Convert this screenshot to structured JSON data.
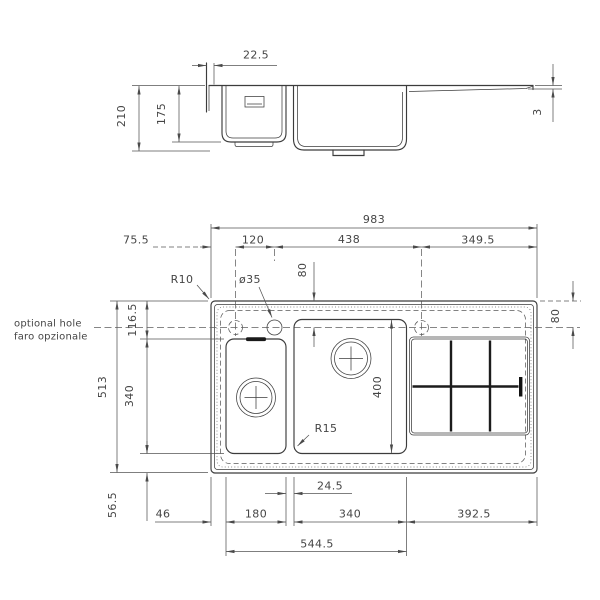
{
  "side_view": {
    "rim_offset": "22.5",
    "total_depth": "210",
    "bowl_depth": "175",
    "drainer_step": "3"
  },
  "plan": {
    "overall_width": "983",
    "edge_to_hole1": "75.5",
    "hole1_to_hole2": "120",
    "hole2_to_hole3": "438",
    "hole3_to_edge": "349.5",
    "overall_depth": "513",
    "top_to_bowl": "116.5",
    "small_bowl_length": "340",
    "bowl_to_bottom_edge": "56.5",
    "hole_offset_left": "80",
    "hole_offset_right": "80",
    "big_bowl_depth": "400",
    "bowl_gap": "24.5",
    "edge_to_small_bowl": "46",
    "small_bowl_width": "180",
    "big_bowl_width": "340",
    "big_bowl_to_edge": "392.5",
    "bowls_span": "544.5",
    "corner_radius_outer": "R10",
    "corner_radius_bowl": "R15",
    "tap_hole_diameter": "ø35"
  },
  "annotations": {
    "optional_hole_en": "optional hole",
    "optional_hole_it": "faro opzionale"
  }
}
